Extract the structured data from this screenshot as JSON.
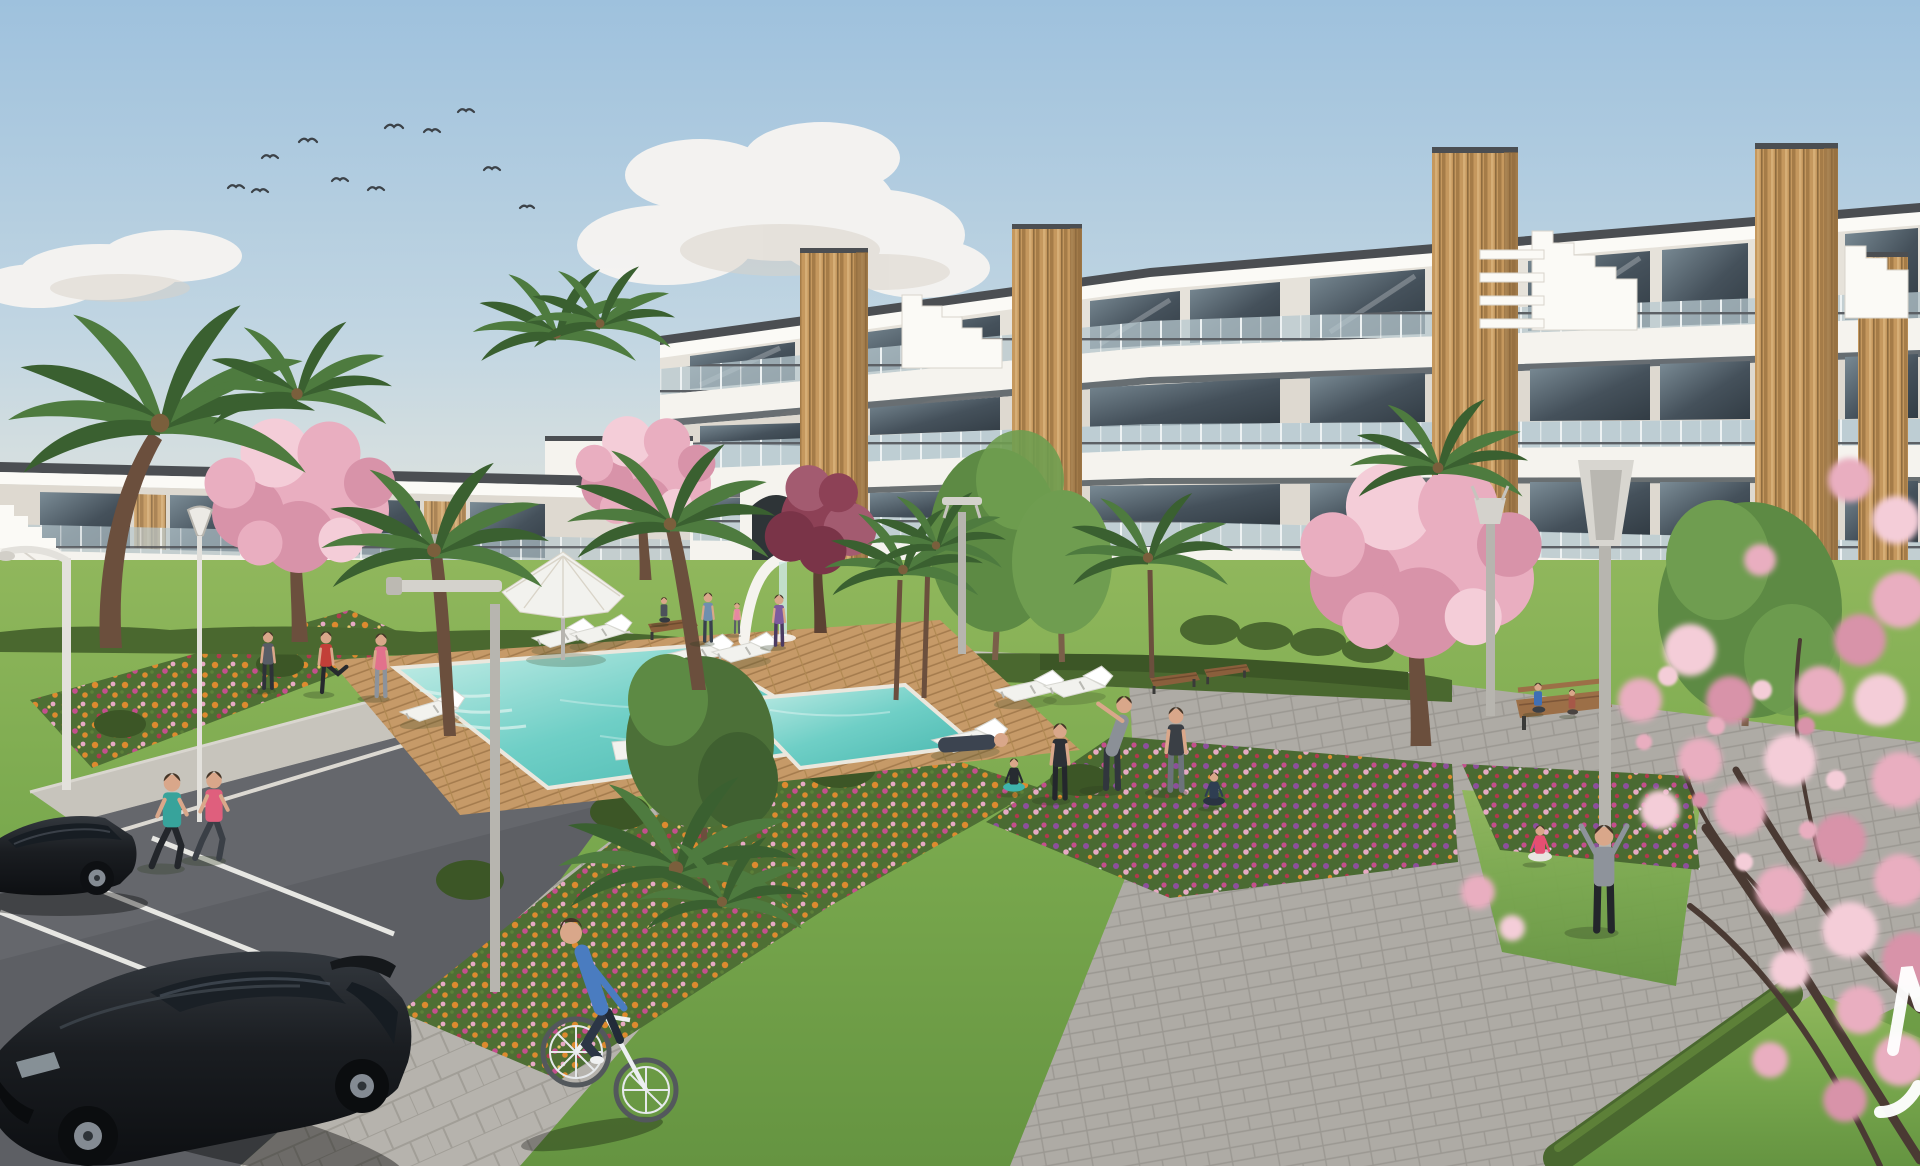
{
  "scene": {
    "description": "Sunny 3D architectural rendering of a modern white apartment complex with stepped roof terraces and wooden panel accents surrounding a landscaped courtyard. A turquoise swimming pool with a wooden deck, white sun loungers and a white parasol sits in a large lawn edged by colorful flower beds, clipped hedges, palm trees and pink cherry-blossom trees. Residents stretch and do yoga on the grass, two women jog along a path beside an angled parking bay with two black cars, a man rides a bicycle on a paved walk, people sit on benches near the building, birds fly in the pale blue sky, and blurred pink blossom branches with a partially cropped white watermark letter overhang the right edge.",
    "time_of_day": "day",
    "style": "photorealistic render"
  },
  "labels": {
    "image": "architectural rendering of apartment complex with pool courtyard",
    "sky": "pale blue sky",
    "clouds": "white clouds",
    "birds": "flock of birds",
    "building_right": "three-storey white apartment building with wood accents",
    "building_left": "two-storey white apartment wing",
    "arch": "arched passage",
    "waterfall": "white arch water feature",
    "pool": "turquoise swimming pool",
    "pool_small": "small splash pool",
    "deck": "wooden pool deck",
    "diving_board": "white diving board",
    "parasol": "white parasol",
    "loungers": "white sun loungers",
    "lawn": "courtyard lawn",
    "flower_beds": "colorful flower beds",
    "hedges": "clipped hedges",
    "palms": "palm trees",
    "blossoms": "pink blossom trees",
    "foreground_blossom": "foreground cherry blossom branches",
    "plaza": "paved plaza",
    "paths": "walking paths",
    "parking": "parking bay with white lines",
    "car_1": "dark parked sedan",
    "car_2": "black parked hatchback",
    "cyclist": "man riding bicycle",
    "joggers": "two women jogging",
    "exercise_group": "people exercising on lawn",
    "yoga_group": "people doing yoga",
    "bench_people": "people sitting on benches",
    "lamps": "modern street lamps",
    "watermark": "partial white watermark letters cropped at right edge"
  },
  "watermark": {
    "fragment_1": "partial letter stroke",
    "fragment_2": "partial curved stroke",
    "color": "#ffffff"
  },
  "palette": {
    "skyTop": "#9ec1dd",
    "skyMid": "#c2d6e2",
    "skyLow": "#dfe3de",
    "horizonGlow": "#e9e3d6",
    "cloud": "#f6f4f1",
    "cloudShade": "#d9d2c8",
    "white": "#f5f3ee",
    "whiteBright": "#fbfaf6",
    "whiteShade": "#e6e2da",
    "wallShade": "#ded9d0",
    "cap": "#4b4e52",
    "slabShadow": "#565a5e",
    "glass": "#45515b",
    "glassLight": "#7b8c96",
    "balustrade": "#b7c8cf",
    "mullion": "#edf2f3",
    "wood": "#c5985e",
    "woodDark": "#a57c48",
    "woodLight": "#d6ae76",
    "ochre": "#bd9257",
    "ochreDark": "#8f6c3f",
    "hedge": "#4a682f",
    "hedgeDark": "#3c5626",
    "hedgeLight": "#5d8038",
    "grassTop": "#90b75c",
    "grass": "#7aa94e",
    "grassDark": "#659441",
    "deck": "#c69a68",
    "deckLine": "#a57c4e",
    "poolLight": "#c8eee8",
    "pool": "#6fcfc6",
    "poolDeep": "#46b5ad",
    "path": "#c7c4bc",
    "plaza": "#aeaba5",
    "plazaLine": "#9b9892",
    "walk": "#b6b3ad",
    "walkLine": "#a19e97",
    "asphalt": "#5d5f64",
    "asphaltLight": "#6e7075",
    "line": "#e7e7e3",
    "flowerOrange": "#dd8a2f",
    "flowerMagenta": "#c44f8d",
    "flowerPink": "#e7a9c4",
    "flowerRed": "#b03a4e",
    "flowerPurple": "#8d4f9b",
    "blossom": "#e9aec0",
    "blossomLight": "#f4cdd8",
    "blossomDeep": "#d893a9",
    "blossomDark": "#8d4156",
    "blossomDarkLight": "#a35b70",
    "trunk": "#6b4f3d",
    "branch": "#4a3a33",
    "palm": "#4e7b3f",
    "palmDark": "#3a6030",
    "leaf": "#5d8a44",
    "leafLight": "#6f9d50",
    "bird": "#3c4248",
    "lampWhite": "#e3e1dc",
    "pole": "#b7b5af",
    "car": "#1c1f23",
    "carHi": "#3d434a",
    "carGlass": "#171d23",
    "rim": "#848b93",
    "skin": "#d9a78a",
    "hair": "#453527",
    "furniture": "#f2f2ee",
    "watermark": "#ffffff"
  }
}
